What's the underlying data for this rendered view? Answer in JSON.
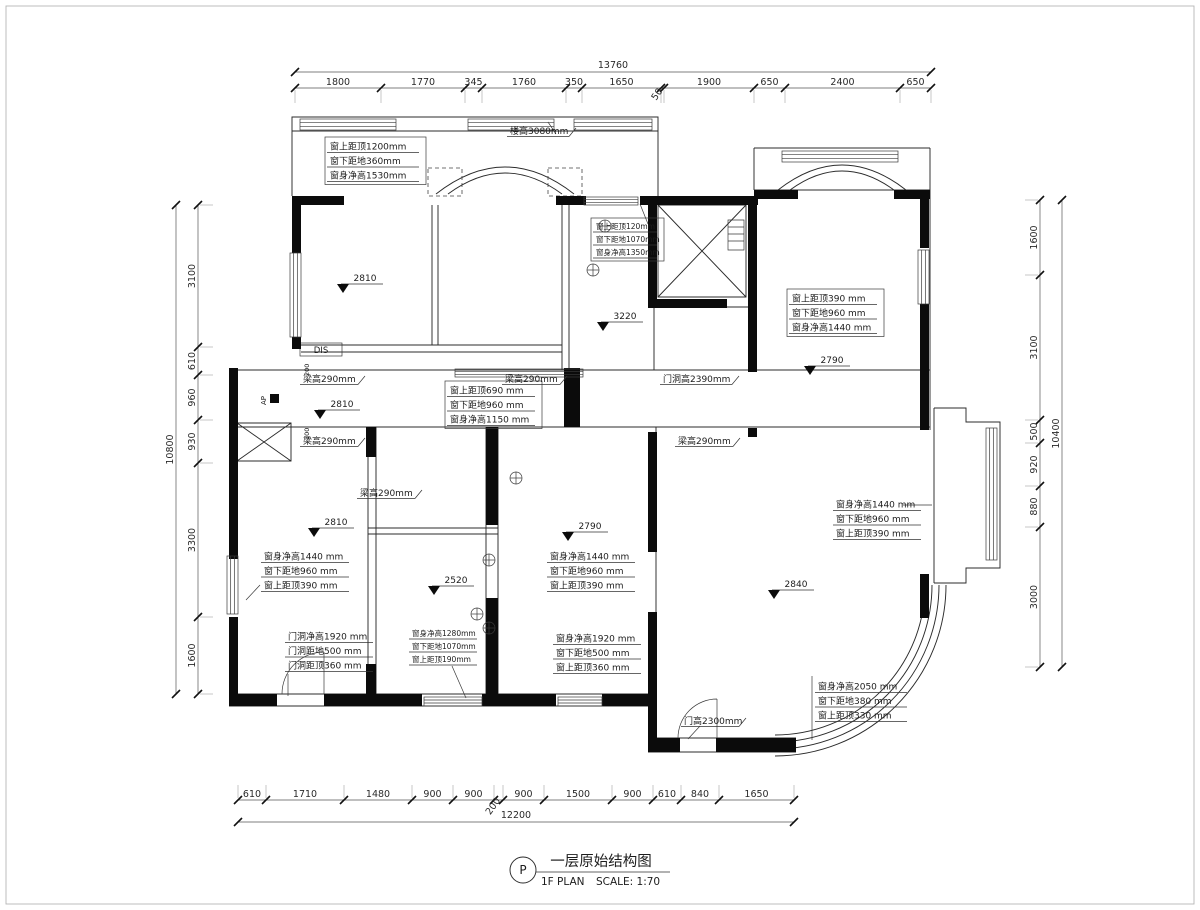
{
  "title": {
    "marker": "P",
    "name_cn": "一层原始结构图",
    "name_en": "1F PLAN",
    "scale": "SCALE: 1:70"
  },
  "dimensions": {
    "top": {
      "total": "13760",
      "segments": [
        "1800",
        "1770",
        "345",
        "1760",
        "350",
        "1650",
        "50",
        "1900",
        "650",
        "2400",
        "650"
      ]
    },
    "bottom": {
      "total": "12200",
      "segments": [
        "610",
        "1710",
        "1480",
        "900",
        "900",
        "200",
        "900",
        "1500",
        "900",
        "610",
        "840",
        "1650"
      ]
    },
    "left": {
      "total": "10800",
      "segments": [
        "3100",
        "610",
        "960",
        "930",
        "3300",
        "1600"
      ]
    },
    "right": {
      "total": "10400",
      "segments": [
        "1600",
        "3100",
        "500",
        "920",
        "880",
        "3000"
      ]
    }
  },
  "levels": [
    "2810",
    "3220",
    "2790",
    "2810",
    "2810",
    "2790",
    "2520",
    "2840"
  ],
  "notes": {
    "beam_height": "梁高290mm",
    "slab_height": "楼高3080mm",
    "door_opening_height": "门洞高2390mm",
    "door_height": "门高2300mm",
    "dis": "DIS",
    "ap": "AP",
    "small_dim_200": "200",
    "blocks": {
      "win_top_left": [
        "窗上距顶1200mm",
        "窗下距地360mm",
        "窗身净高1530mm"
      ],
      "win_hall": [
        "窗上距顶120mm",
        "窗下距地1070mm",
        "窗身净高1350mm"
      ],
      "win_right_top": [
        "窗上距顶390 mm",
        "窗下距地960 mm",
        "窗身净高1440 mm"
      ],
      "win_corridor": [
        "窗上距顶690 mm",
        "窗下距地960 mm",
        "窗身净高1150 mm"
      ],
      "win_lower_left": [
        "窗身净高1440 mm",
        "窗下距地960 mm",
        "窗上距顶390 mm"
      ],
      "door_lower_left": [
        "门洞净高1920 mm",
        "门洞距地500 mm",
        "门洞距顶360 mm"
      ],
      "win_bottom_small": [
        "窗身净高1280mm",
        "窗下距地1070mm",
        "窗上距顶190mm"
      ],
      "win_lower_mid": [
        "窗身净高1440 mm",
        "窗下距地960 mm",
        "窗上距顶390 mm"
      ],
      "win_lower_mid2": [
        "窗身净高1920 mm",
        "窗下距地500 mm",
        "窗上距顶360 mm"
      ],
      "win_right_bay": [
        "窗身净高1440 mm",
        "窗下距地960 mm",
        "窗上距顶390 mm"
      ],
      "win_bottom_right": [
        "窗身净高2050 mm",
        "窗下距地380 mm",
        "窗上距顶330 mm"
      ]
    }
  }
}
